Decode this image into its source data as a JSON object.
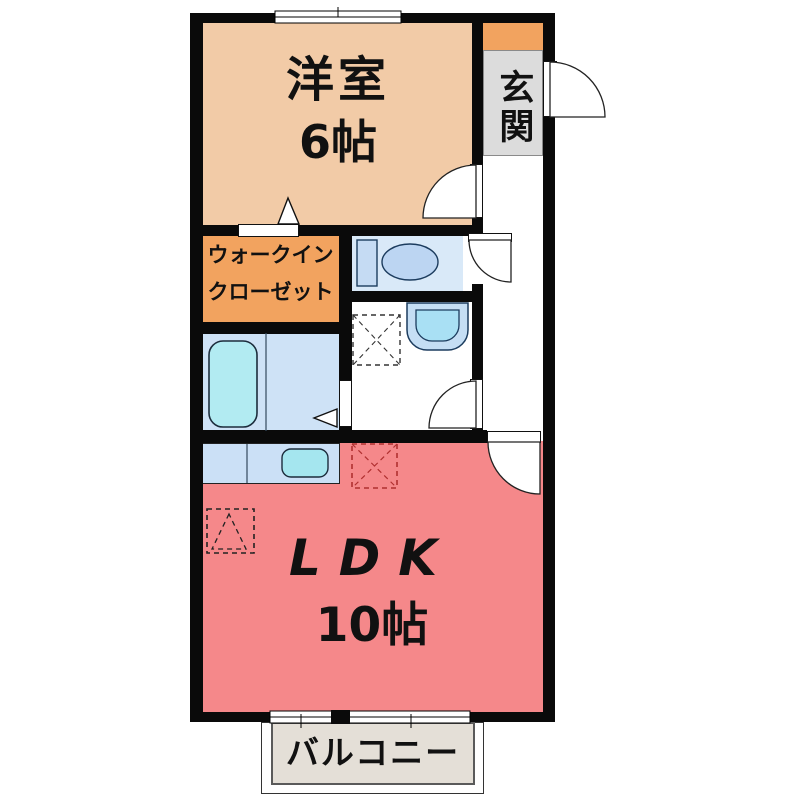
{
  "plan_type": "apartment-floorplan",
  "rooms": {
    "western_room": {
      "label": "洋室",
      "size": "6帖"
    },
    "entrance": {
      "label": "玄関"
    },
    "walk_in_closet": {
      "label_line1": "ウォークイン",
      "label_line2": "クローゼット"
    },
    "ldk": {
      "label": "LDK",
      "size": "10帖"
    },
    "balcony": {
      "label": "バルコニー"
    }
  },
  "colors": {
    "wall": "#0a0a0a",
    "western_room_floor": "#F2CBA7",
    "entrance_cabinet": "#F2A35F",
    "entrance_floor": "#DCDCDC",
    "closet_floor": "#F2A35F",
    "ldk_floor": "#F5888A",
    "balcony_floor": "#E4DFD7",
    "bathroom_floor": "#CEE2F6",
    "toilet_floor": "#D9E9F8",
    "fixture_cyan": "#B2EBF2",
    "fixture_blue": "#C5DBF3",
    "kitchen_counter": "#CBE0F6",
    "refrigerator_dash": "#B03030"
  }
}
